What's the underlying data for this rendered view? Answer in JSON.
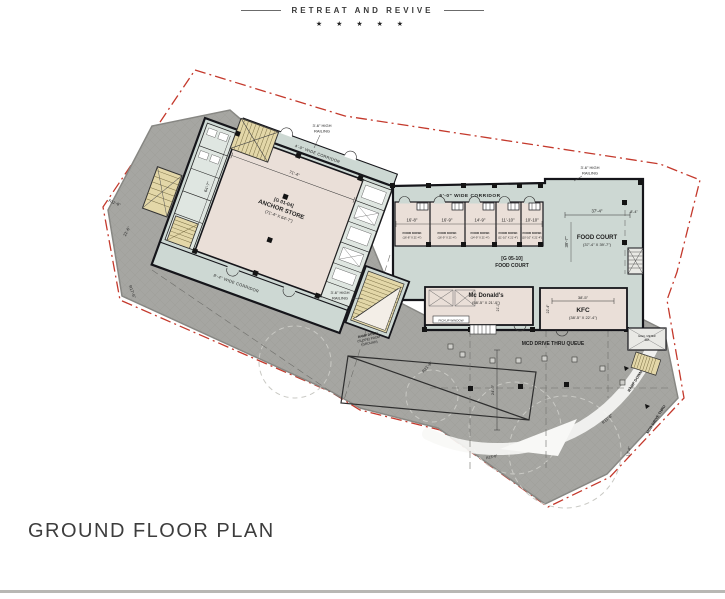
{
  "header": {
    "brand": "RETREAT AND REVIVE",
    "stars": "★ ★ ★ ★ ★"
  },
  "title": "GROUND FLOOR PLAN",
  "colors": {
    "boundary": "#c4392c",
    "driveway": "#a6a6a2",
    "building": "#cdd8d3",
    "retail": "#eadfd8",
    "stair": "#e3d7a8"
  },
  "plan": {
    "anchor": {
      "unit": "[G 01-04]",
      "name": "ANCHOR STORE",
      "size": "(71'-4\" X 64'-7\")",
      "dim_w": "71'-4\"",
      "dim_h": "64'-7\""
    },
    "corridors": {
      "anchor_bottom": "8'-4\" WIDE CORRIDOR",
      "anchor_top": "4'-0\" WIDE CORRIDOR",
      "food_court": "6'-0\" WIDE CORRIDOR"
    },
    "railings": {
      "top_left": "3'-6\" HIGH",
      "top_left2": "RAILING",
      "top_right": "3'-6\" HIGH",
      "top_right2": "RAILING",
      "mid": "3'-6\" HIGH",
      "mid2": "RAILING"
    },
    "kiosks": [
      {
        "dim": "16'-8\"",
        "name": "FOOD KIOSK",
        "size": "(16'-8\" X 21'-4\")"
      },
      {
        "dim": "16'-9\"",
        "name": "FOOD KIOSK",
        "size": "(16'-9\" X 21'-4\")"
      },
      {
        "dim": "14'-9\"",
        "name": "FOOD KIOSK",
        "size": "(14'-9\" X 21'-4\")"
      },
      {
        "dim": "11'-10\"",
        "name": "FOOD KIOSK",
        "size": "(11'-10\" X 21'-4\")"
      },
      {
        "dim": "10'-10\"",
        "name": "FOOD KIOSK",
        "size": "(10'-10\" X 21'-4\")"
      }
    ],
    "food_court_unit": {
      "unit": "[G 05-10]",
      "name": "FOOD COURT"
    },
    "food_court": {
      "name": "FOOD COURT",
      "size": "(37'-4\" X 39'-7\")",
      "dim_w": "37'-4\"",
      "dim_h": "39'-7\"",
      "dim_right": "8'-4\""
    },
    "mcdonalds": {
      "name": "Mc Donald's",
      "size": "(58'-5\" X 21'-0\")",
      "dim_h": "21'-0\"",
      "pickup": "PICKUP WINDOW"
    },
    "kfc": {
      "name": "KFC",
      "size": "(38'-5\" X 22'-4\")",
      "dim_w": "38'-5\"",
      "dim_h": "22'-4\""
    },
    "drive": {
      "queue": "MCD DRIVE THRU QUEUE",
      "ramp_down": "RAMP DOWN",
      "mcd_drive": "MCD DRIVE THRU",
      "ramp_note_1": "RAMP DOWN",
      "ramp_note_2": "(SLOPE) FROM",
      "ramp_note_3": "(GROUND)",
      "elec_1": "ELEC. METER",
      "elec_2": "SET"
    },
    "dims": {
      "r_left": "R11'-8\"",
      "d_left": "21'-6\"",
      "r_left2": "R17'-6\"",
      "r_mid": "R21'-6\"",
      "d_queue": "24'-6\"",
      "d_bottom": "13'-4\"",
      "r_bottom": "R11'-8\"",
      "r_bottom2": "R13'-8\""
    }
  }
}
